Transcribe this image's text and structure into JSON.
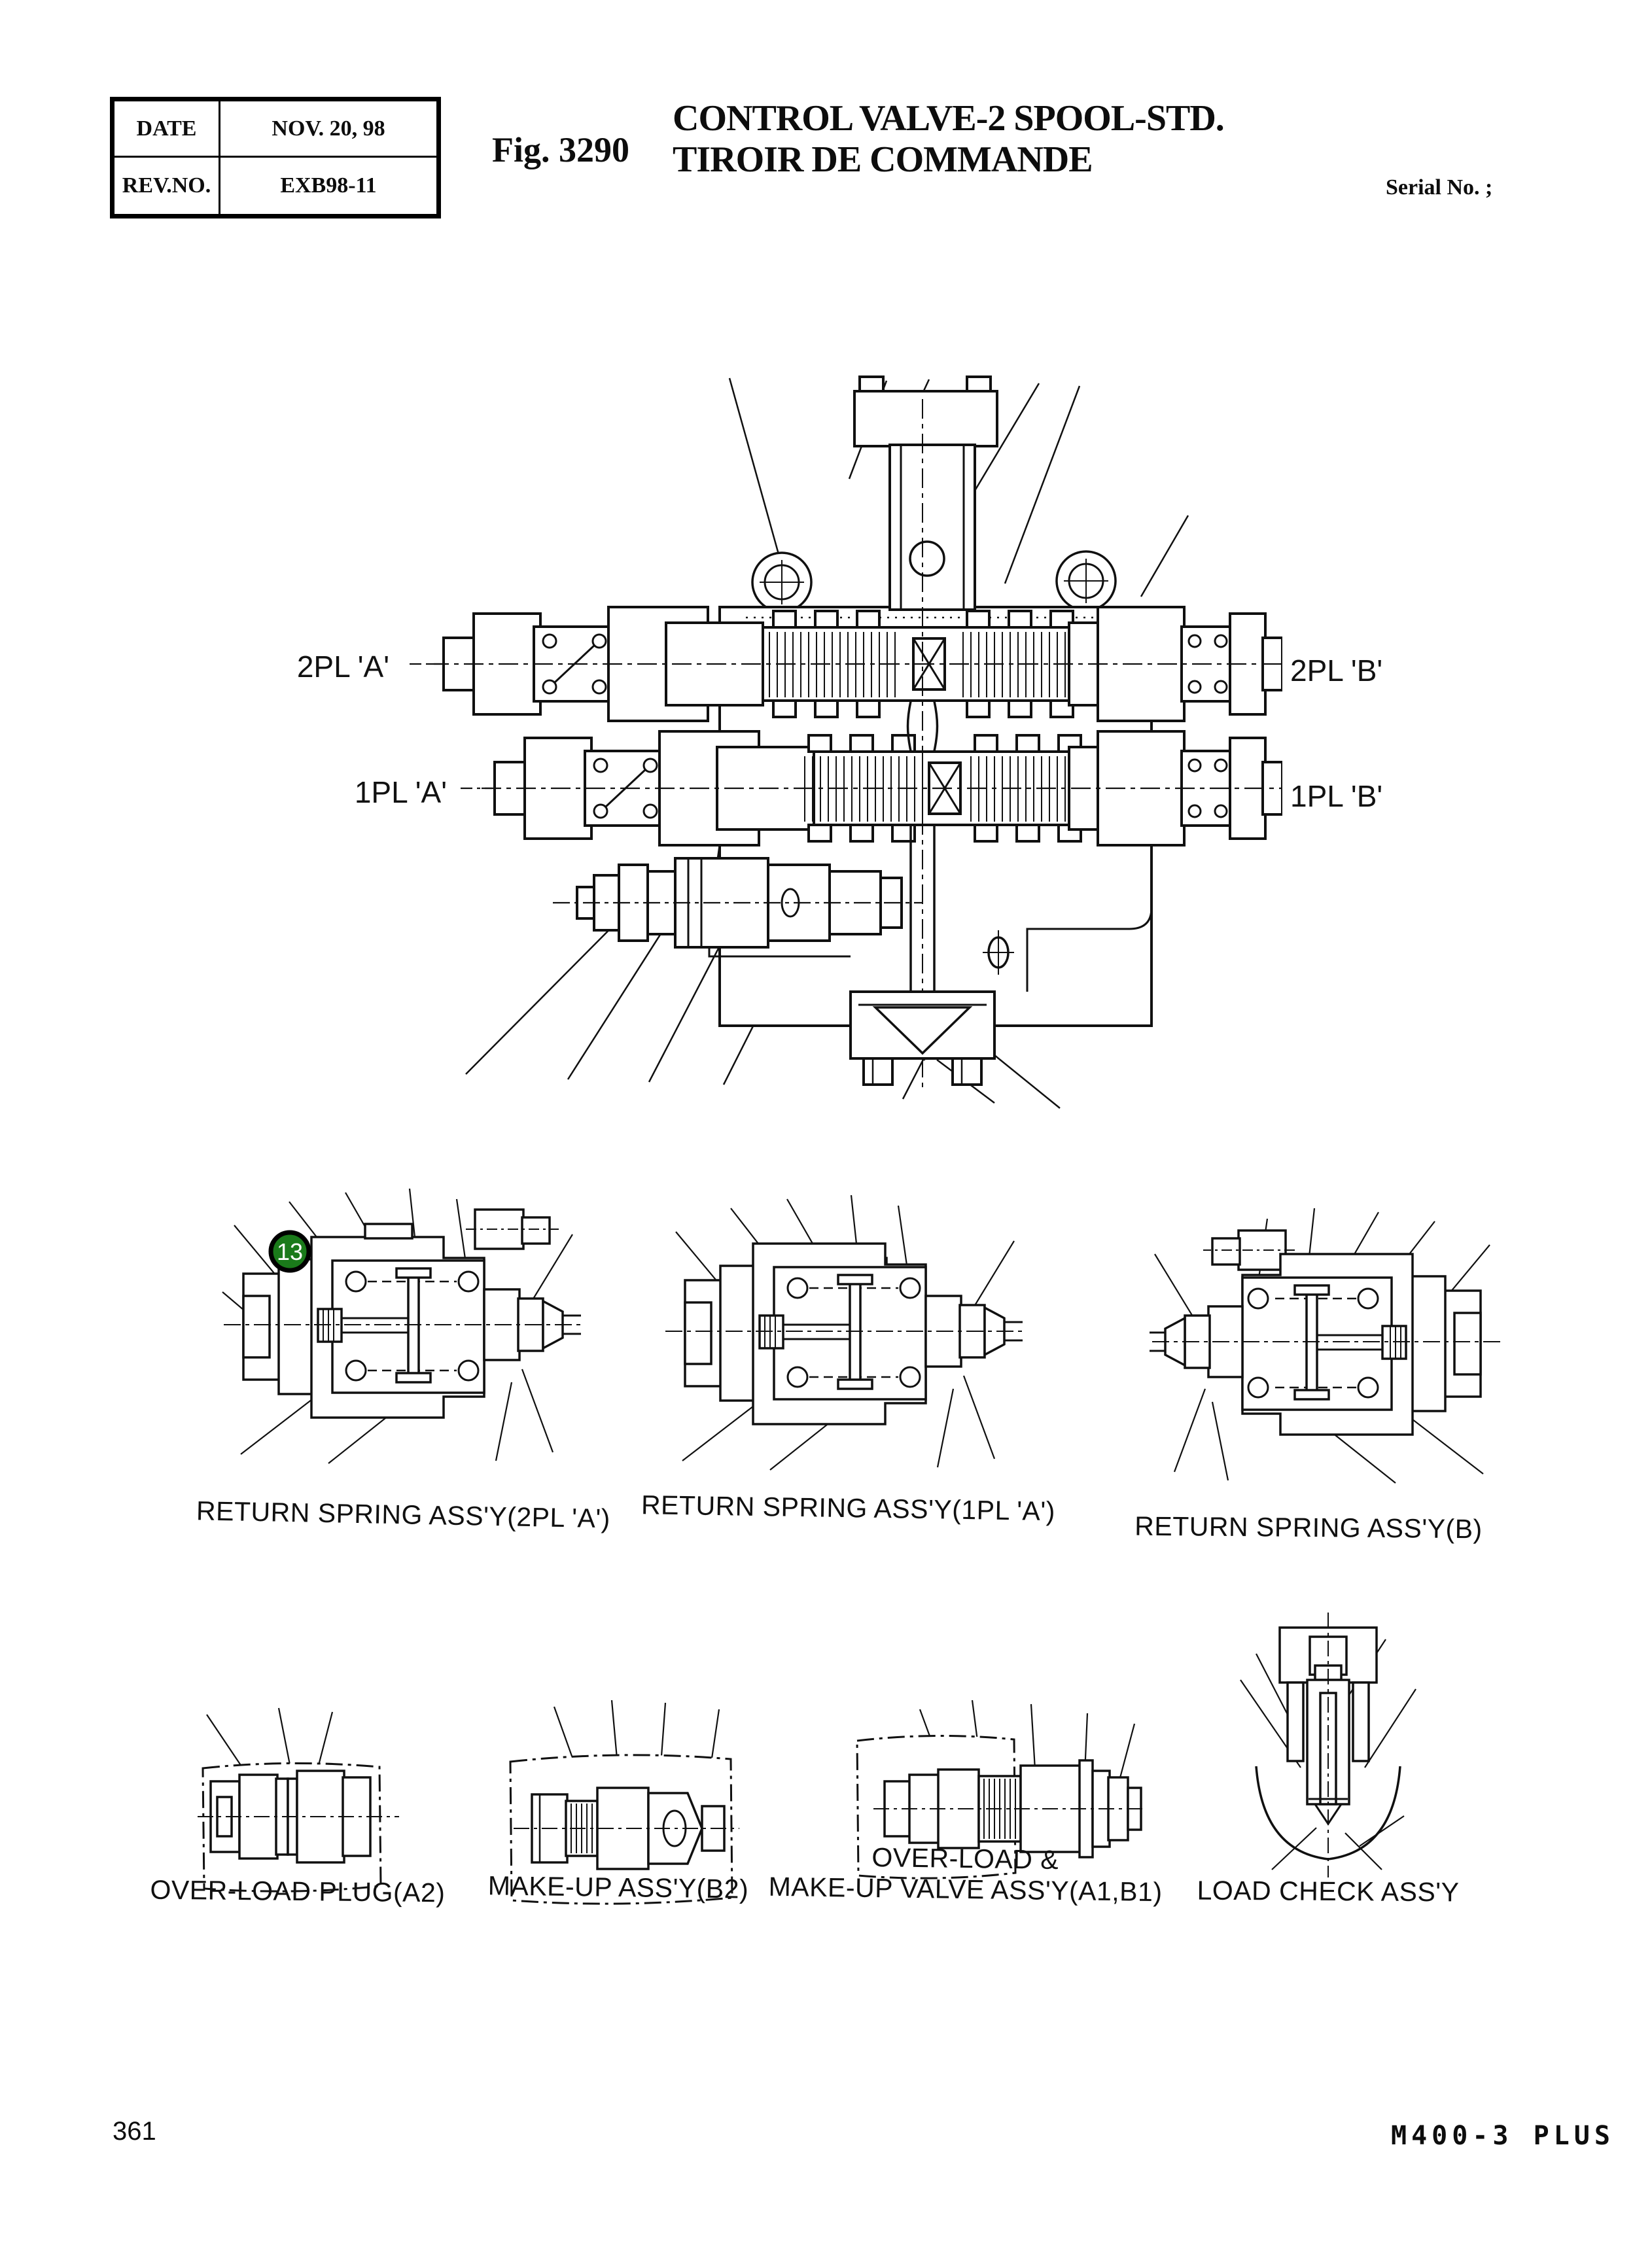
{
  "header": {
    "info_table": {
      "row1_label": "DATE",
      "row1_value": "NOV. 20, 98",
      "row2_label": "REV.NO.",
      "row2_value": "EXB98-11"
    },
    "fig_label": "Fig. 3290",
    "title_line1": "CONTROL VALVE-2 SPOOL-STD.",
    "title_line2": "TIROIR DE COMMANDE",
    "serial_label": "Serial No. ;"
  },
  "main_diagram": {
    "ports": {
      "pl2a": "2PL 'A'",
      "pl2b": "2PL 'B'",
      "pl1a": "1PL 'A'",
      "pl1b": "1PL 'B'"
    },
    "badge": {
      "number": "13",
      "color": "#1a7a1a"
    }
  },
  "figures": {
    "return_spring_2pl_a": {
      "caption": "RETURN SPRING ASS'Y(2PL 'A')"
    },
    "return_spring_1pl_a": {
      "caption": "RETURN SPRING ASS'Y(1PL 'A')"
    },
    "return_spring_b": {
      "caption": "RETURN SPRING ASS'Y(B)"
    },
    "overload_plug": {
      "caption": "OVER-LOAD PLUG(A2)"
    },
    "makeup_assy": {
      "caption": "MAKE-UP ASS'Y(B2)"
    },
    "overload_makeup": {
      "caption_line1": "OVER-LOAD &",
      "caption_line2": "MAKE-UP VALVE ASS'Y(A1,B1)"
    },
    "load_check": {
      "caption": "LOAD CHECK ASS'Y"
    }
  },
  "footer": {
    "page_number": "361",
    "model_code": "M400-3 PLUS"
  }
}
